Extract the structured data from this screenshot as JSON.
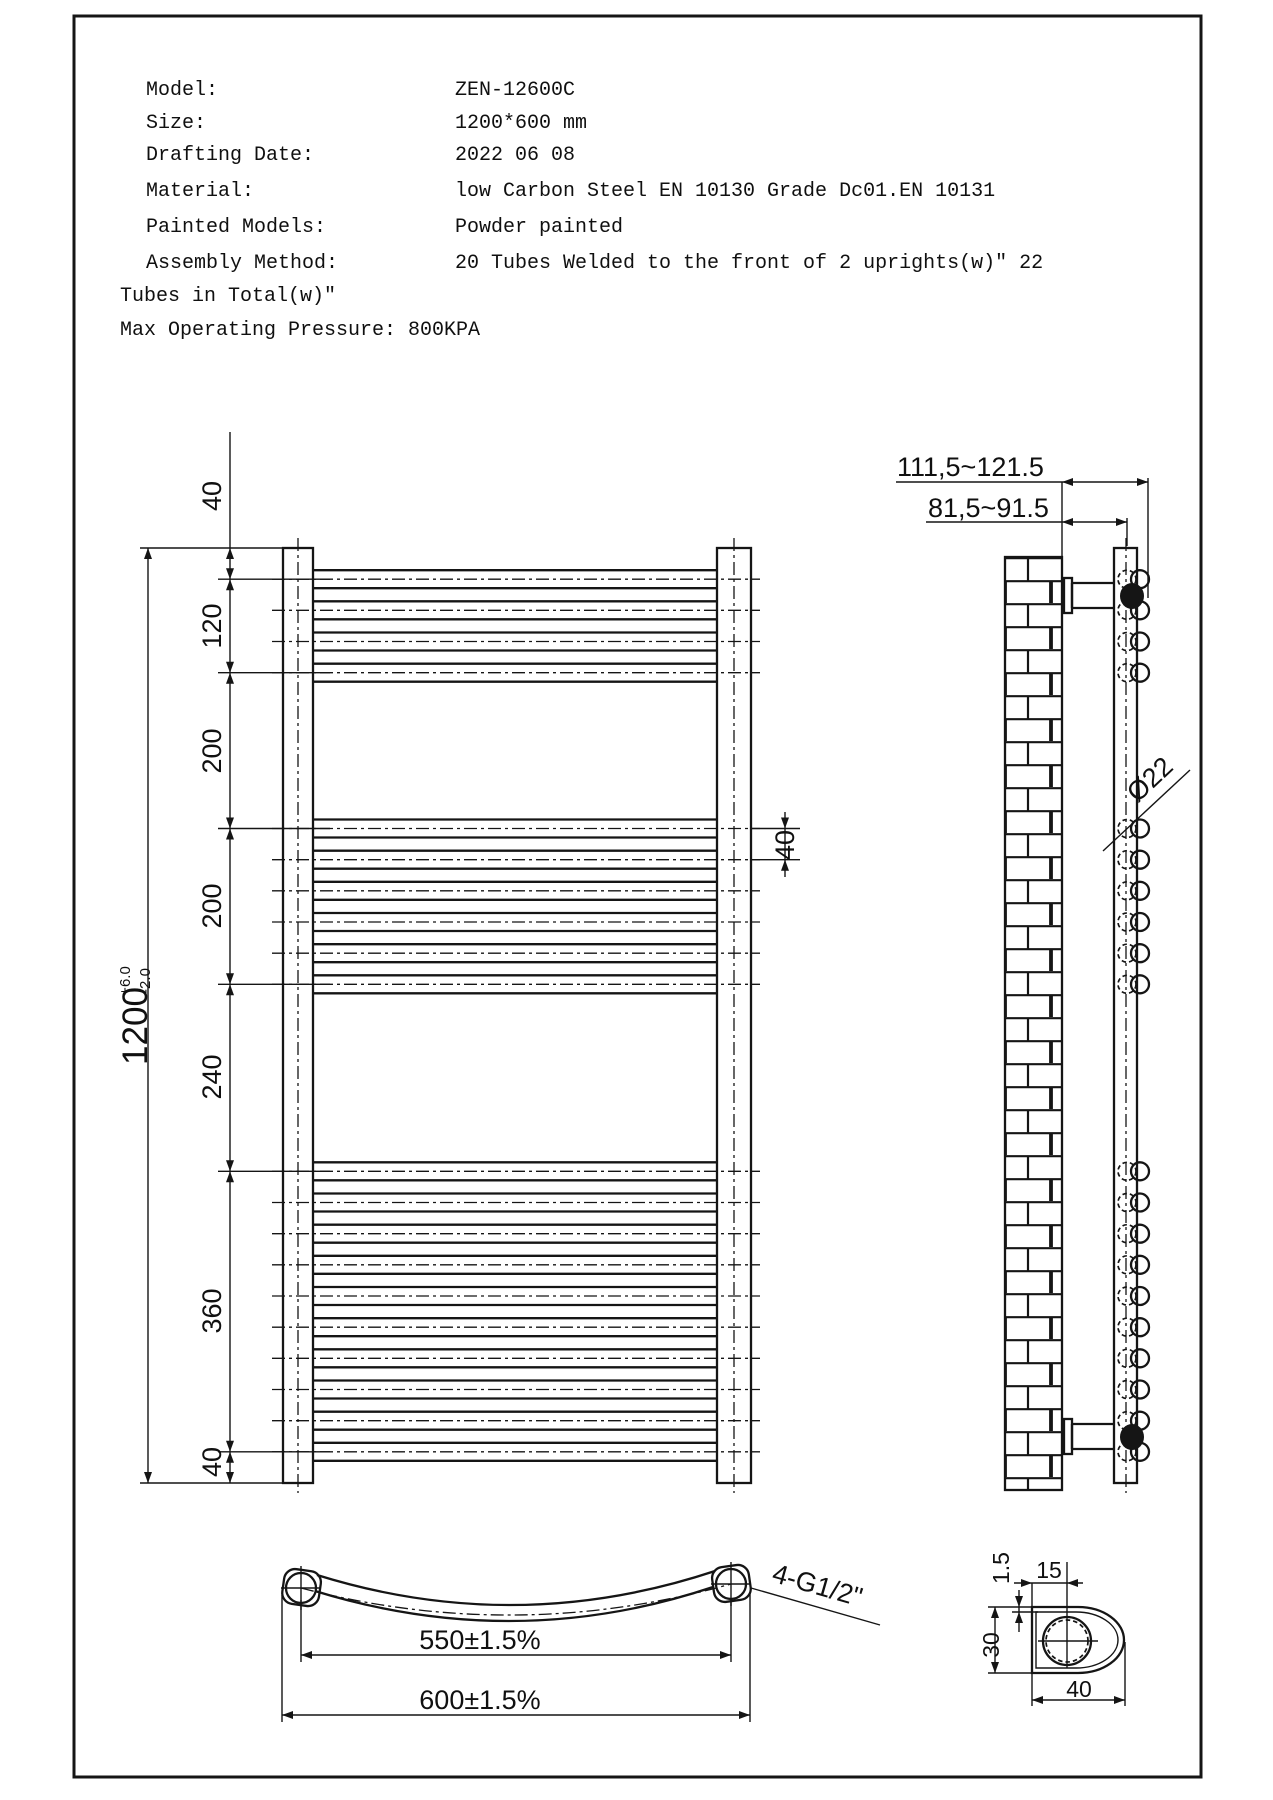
{
  "header": {
    "rows": [
      {
        "label": "Model:",
        "value": "ZEN-12600C"
      },
      {
        "label": "Size:",
        "value": "1200*600 mm"
      },
      {
        "label": "Drafting Date:",
        "value": "2022 06 08"
      },
      {
        "label": "Material:",
        "value": "low Carbon Steel  EN 10130 Grade Dc01.EN 10131"
      },
      {
        "label": "Painted Models:",
        "value": "Powder painted"
      },
      {
        "label": "Assembly Method:",
        "value": "20 Tubes Welded to the front of 2 uprights(w)\"  22"
      }
    ],
    "wrap_line": "Tubes in Total(w)\"",
    "pressure_line": "Max Operating Pressure: 800KPA"
  },
  "front_view": {
    "overall_height": "1200",
    "tolerance_plus": "+6.0",
    "tolerance_minus": "-2.0",
    "segments": [
      "40",
      "120",
      "200",
      "200",
      "240",
      "360",
      "40"
    ],
    "tube_pitch": "40"
  },
  "side_view": {
    "bracket_depth_outer": "111,5~121.5",
    "bracket_depth_inner": "81,5~91.5",
    "tube_diameter": "Ø22"
  },
  "bottom_view": {
    "tube_span": "550±1.5%",
    "overall_width": "600±1.5%",
    "fitting": "4-G1/2\""
  },
  "detail_view": {
    "wall_thickness": "1.5",
    "hole_offset": "15",
    "profile_height": "30",
    "profile_width": "40"
  },
  "colors": {
    "line": "#151515",
    "background": "#ffffff"
  }
}
